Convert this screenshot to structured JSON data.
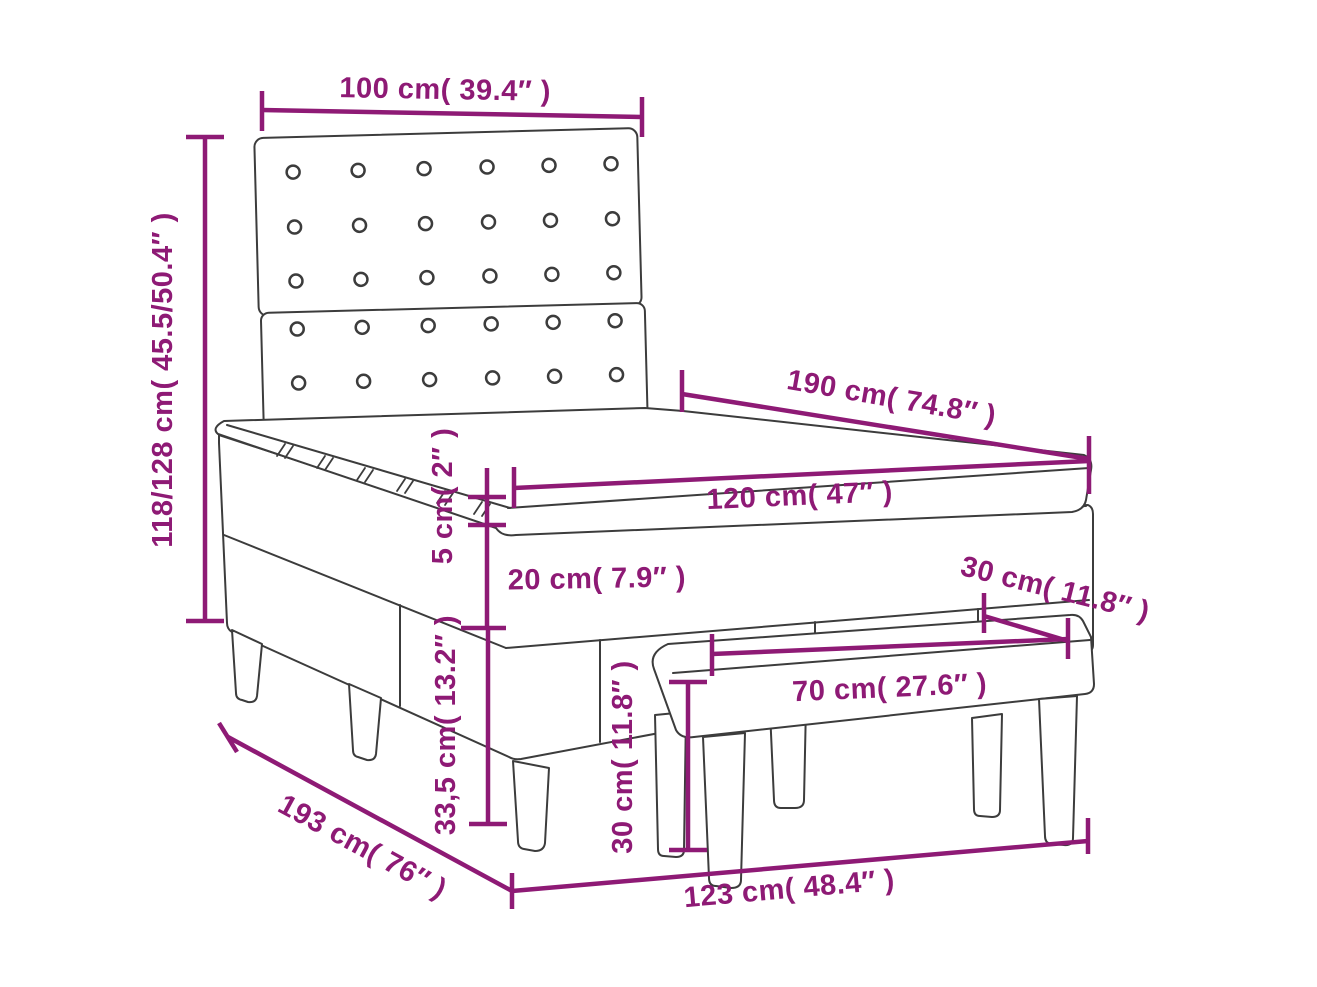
{
  "diagram": {
    "type": "product-dimension-diagram",
    "subject": "box spring bed with tufted headboard, mattress topper and bench",
    "background_color": "#ffffff",
    "accent_color": "#8e1a75",
    "line_color": "#3c3c3c",
    "labels": {
      "headboard_width": "100 cm( 39.4″ )",
      "overall_height": "118/128 cm( 45.5/50.4″ )",
      "bed_length": "190 cm( 74.8″ )",
      "bed_width": "120 cm( 47″ )",
      "topper_thickness": "5 cm( 2″ )",
      "mattress_thickness": "20 cm( 7.9″ )",
      "frame_height": "33,5 cm( 13.2″ )",
      "bench_depth": "30 cm( 11.8″ )",
      "bench_width": "70 cm( 27.6″ )",
      "bench_height": "30 cm( 11.8″ )",
      "overall_length": "193 cm( 76″ )",
      "base_length": "123 cm( 48.4″ )"
    }
  }
}
